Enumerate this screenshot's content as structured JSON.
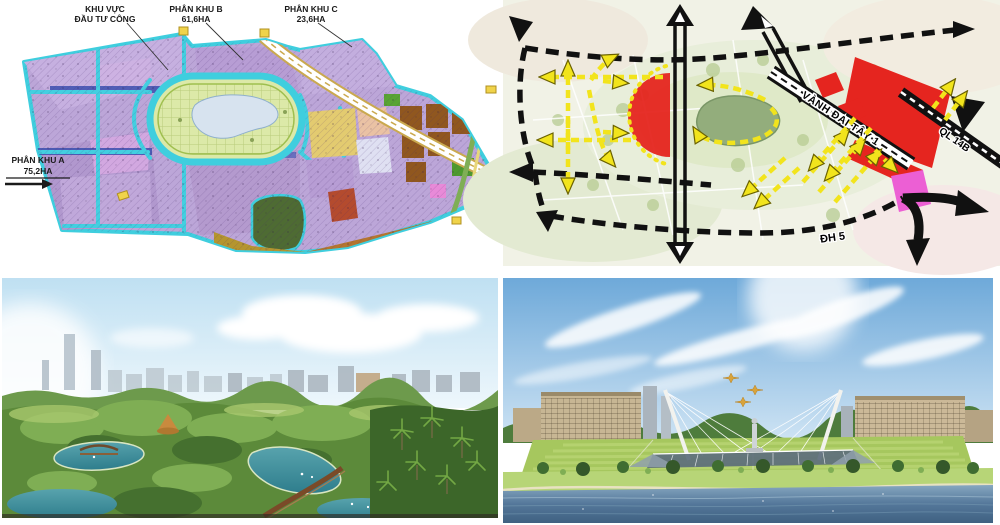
{
  "collage": {
    "master_plan": {
      "label_public_line1": "KHU VỰC",
      "label_public_line2": "ĐẦU TƯ CÔNG",
      "label_b_line1": "PHÂN KHU B",
      "label_b_line2": "61,6HA",
      "label_c_line1": "PHÂN KHU C",
      "label_c_line2": "23,6HA",
      "label_a_line1": "PHÂN KHU A",
      "label_a_line2": "75,2HA",
      "colors": {
        "boundary_road_cyan": "#3fcede",
        "residential_purple": "#bca6d8",
        "park_green": "#dce9a8",
        "lake_blue": "#d7e3ef",
        "mixed_use_yellow": "#e3cb70",
        "commercial_brown": "#90571f",
        "strip_olive": "#b5952f"
      }
    },
    "traffic_diagram": {
      "label_ring_road": "VÀNH ĐAI TÂY 1",
      "label_highway": "QL 14B",
      "label_district_road": "ĐH 5",
      "colors": {
        "flow_arrow_yellow": "#f2e41c",
        "road_black": "#111111",
        "zone_red": "#e5251f",
        "zone_pink": "#ec5fd4",
        "lake_green": "#93ad7c"
      }
    }
  }
}
